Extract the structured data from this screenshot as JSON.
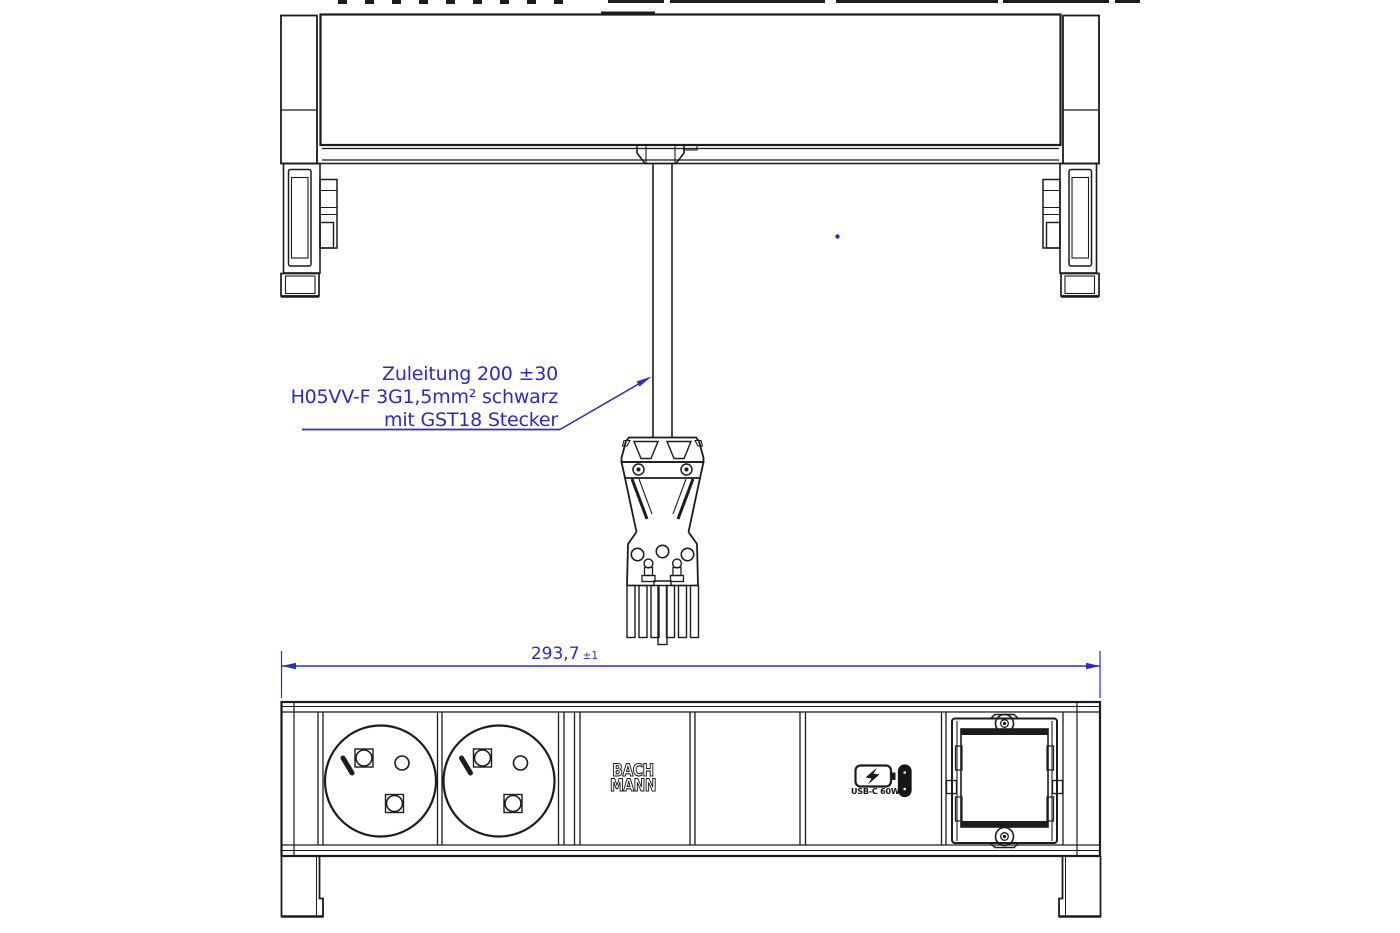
{
  "annotation": {
    "line1": "Zuleitung 200 ±30",
    "line2": "H05VV-F 3G1,5mm² schwarz",
    "line3": "mit GST18 Stecker"
  },
  "dimension": {
    "value": "293,7",
    "tolerance": "±1"
  },
  "front_view": {
    "logo_line1": "BACH",
    "logo_line2": "MANN",
    "usb_label": "USB-C 60W"
  },
  "colors": {
    "annotation_blue": "#2B2BCB",
    "line_color": "#1C1C1C"
  }
}
